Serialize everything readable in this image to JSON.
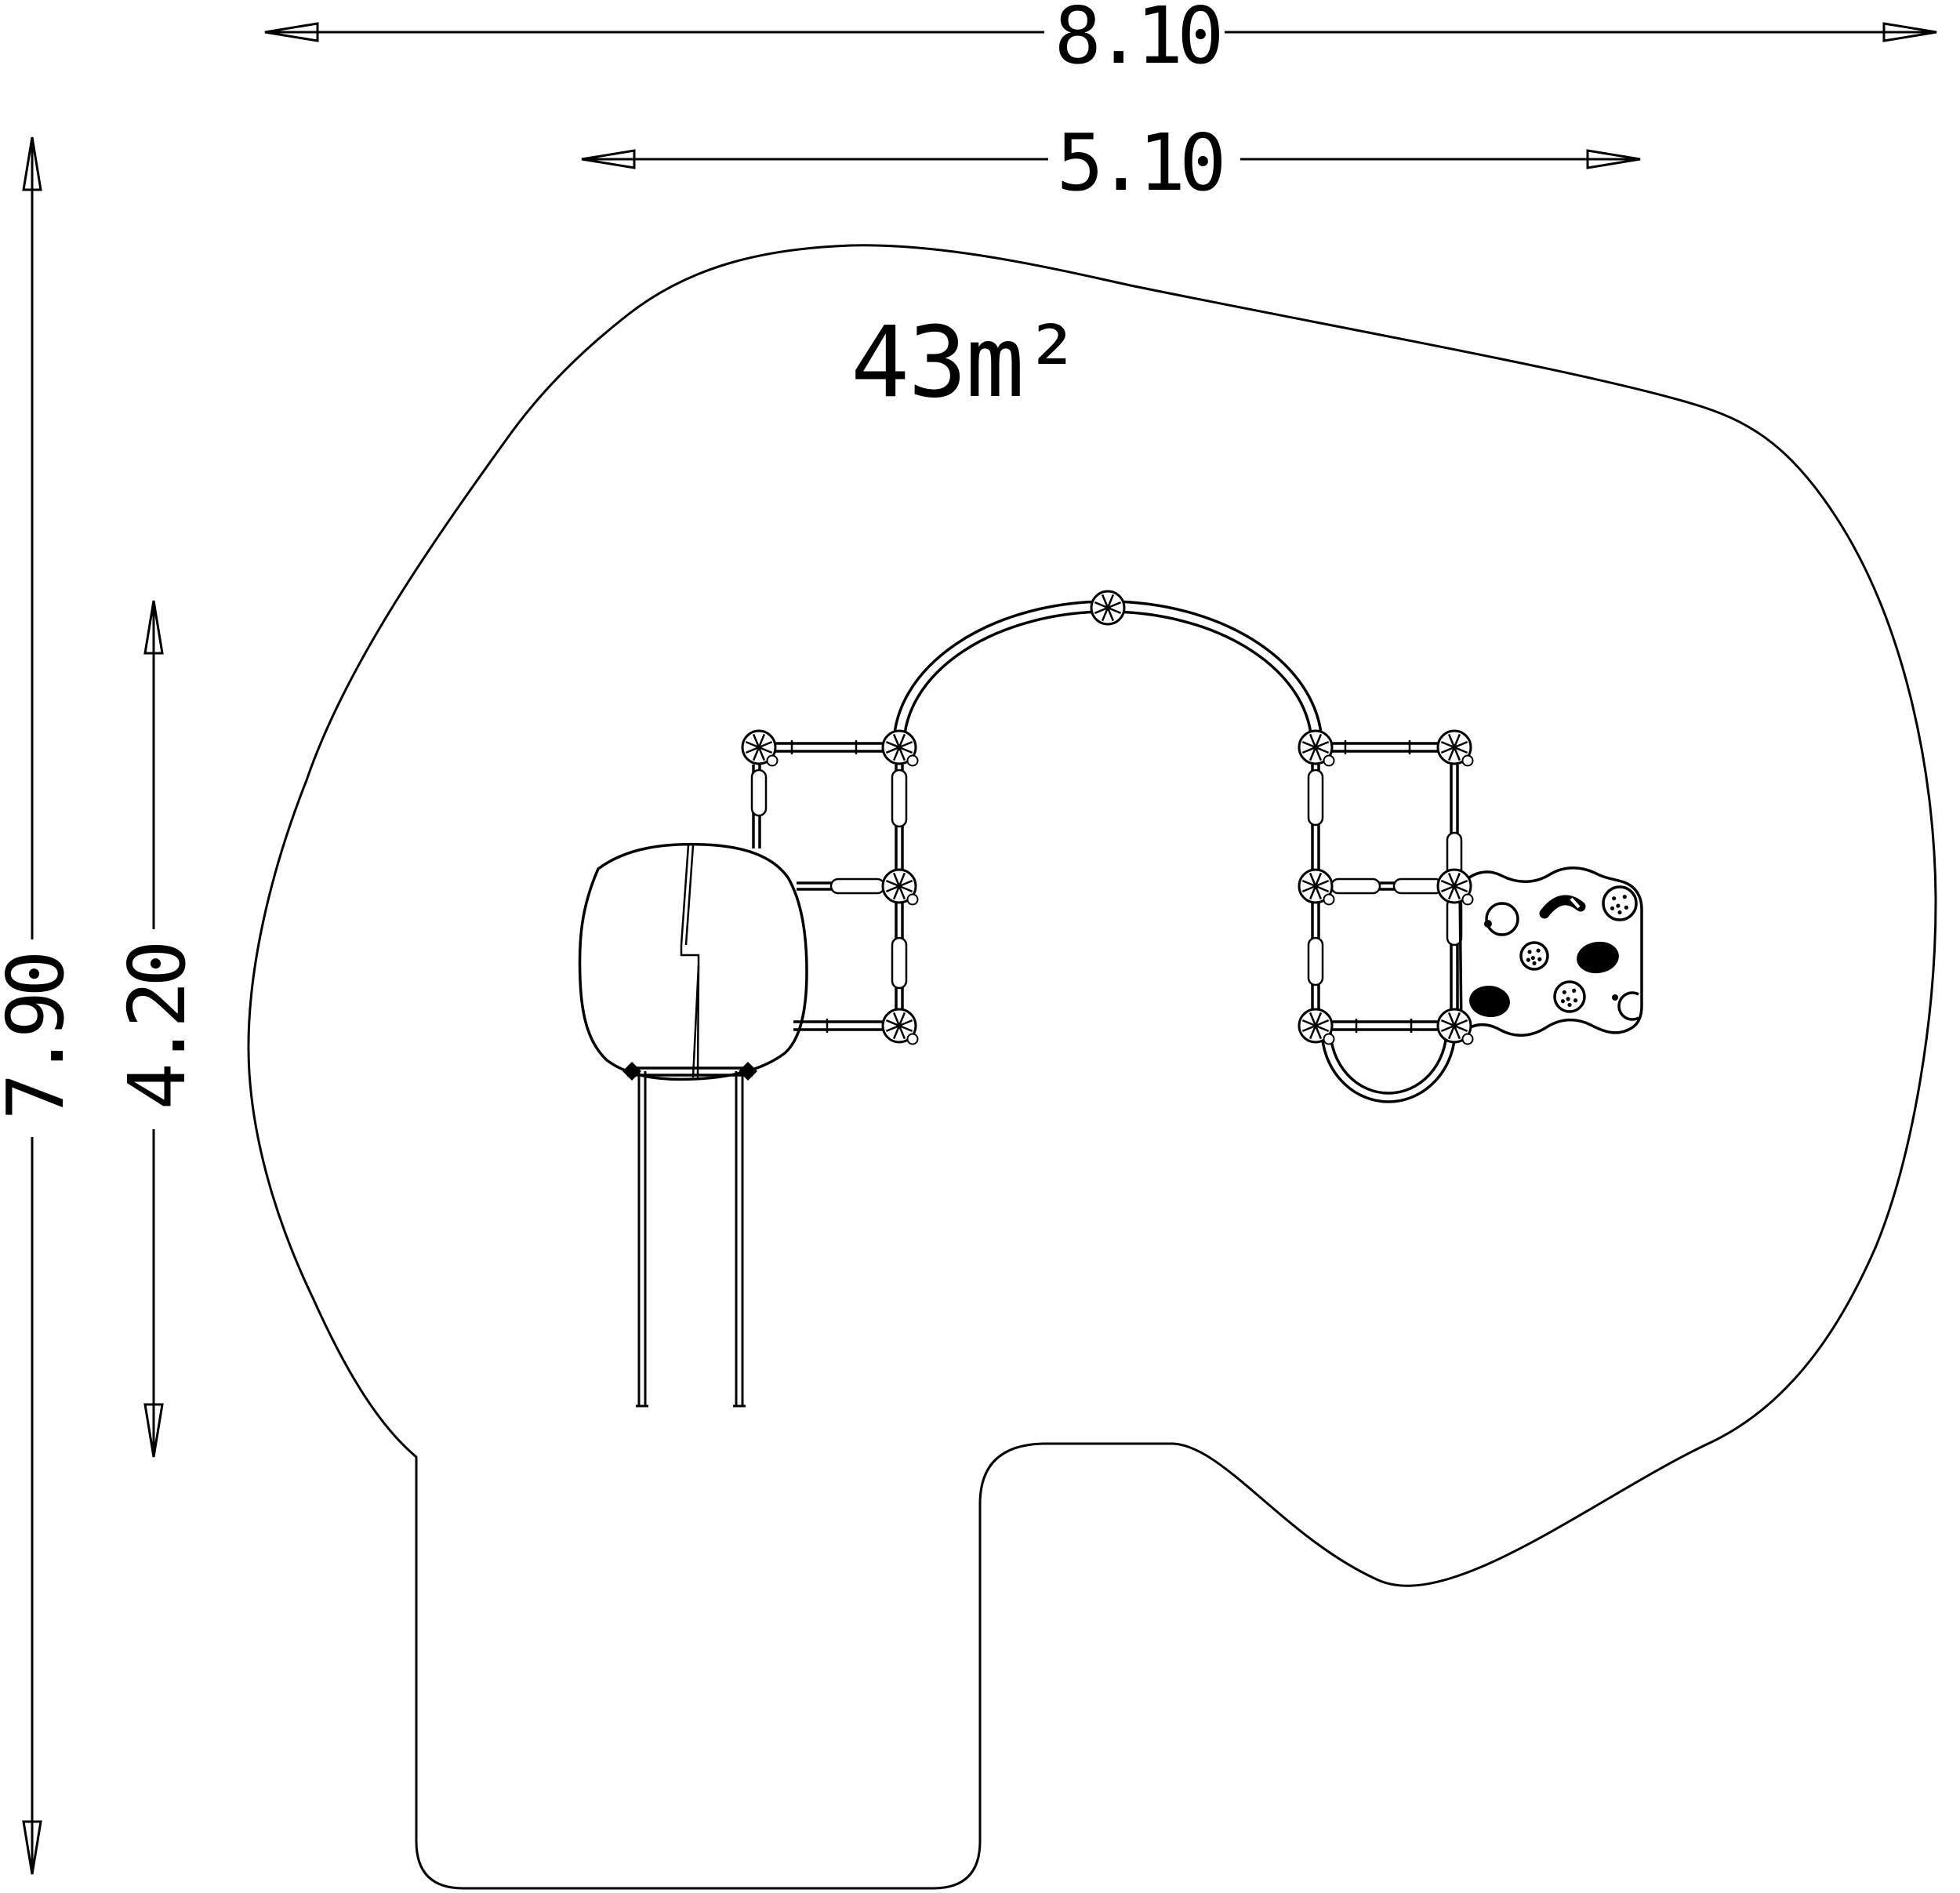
{
  "drawing": {
    "area_label": "43m²",
    "dimensions": {
      "total_width": "8.10",
      "inner_width": "5.10",
      "total_height": "7.90",
      "inner_height": "4.20"
    },
    "stroke_color": "#000000",
    "background_color": "#ffffff"
  }
}
